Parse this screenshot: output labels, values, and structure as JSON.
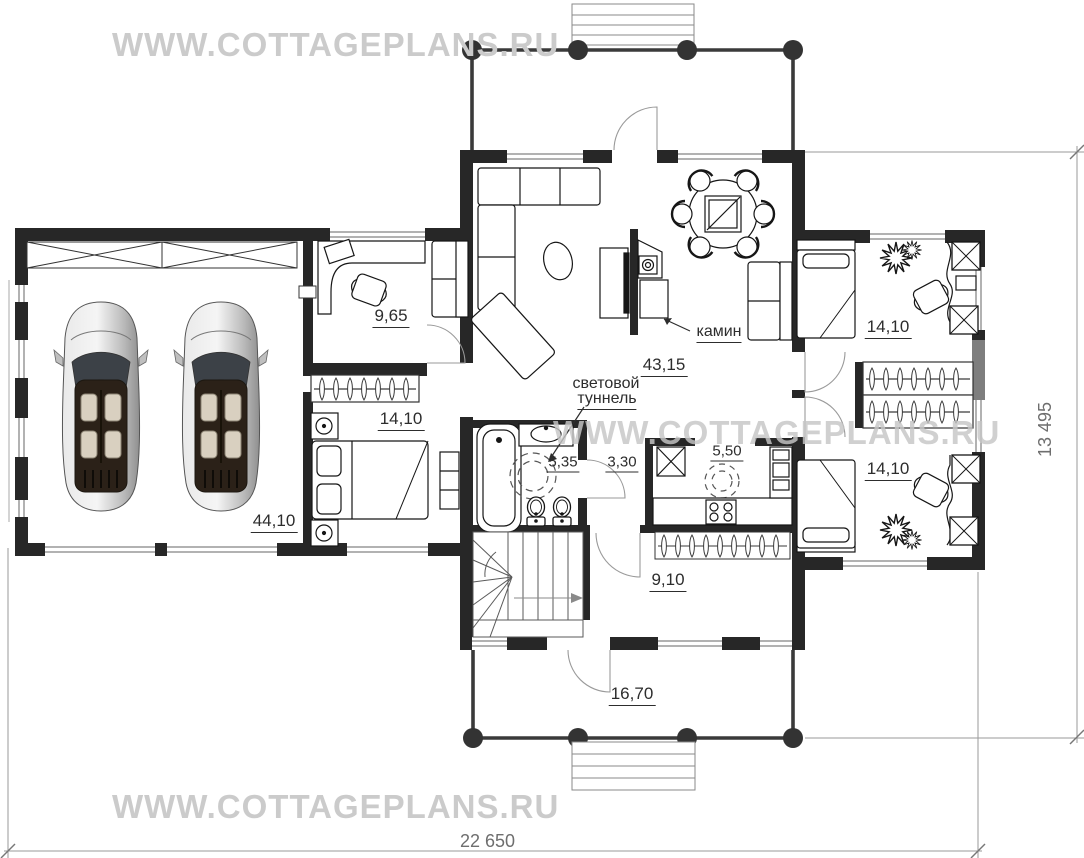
{
  "watermark": {
    "text": "WWW.COTTAGEPLANS.RU"
  },
  "rooms": {
    "garage": {
      "area": "44,10"
    },
    "study": {
      "area": "9,65"
    },
    "bedroom_left": {
      "area": "14,10"
    },
    "living_room": {
      "area": "43,15"
    },
    "bathroom": {
      "area": "5,35"
    },
    "hall": {
      "area": "3,30"
    },
    "kitchen": {
      "area": "5,50"
    },
    "corridor": {
      "area": "9,10"
    },
    "bedroom_right_top": {
      "area": "14,10"
    },
    "bedroom_right_bottom": {
      "area": "14,10"
    },
    "terrace": {
      "area": "16,70"
    }
  },
  "annotations": {
    "fireplace": "камин",
    "light_tunnel_line1": "световой",
    "light_tunnel_line2": "туннель"
  },
  "dimensions": {
    "overall_width": "22 650",
    "overall_height": "13 495"
  },
  "colors": {
    "wall": "#272727",
    "porch_line": "#3a3a3a",
    "watermark": "#cbcbcb",
    "dimension_line": "#9a9a9a"
  }
}
